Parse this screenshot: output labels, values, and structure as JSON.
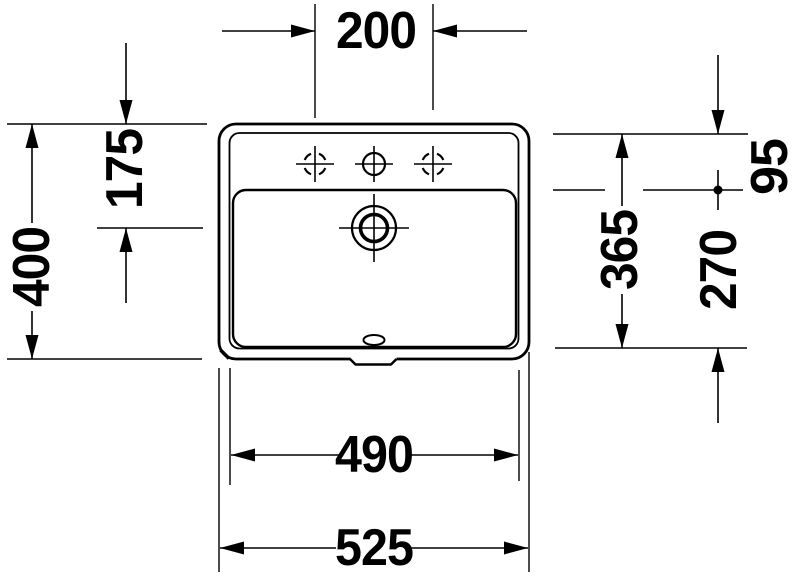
{
  "drawing": {
    "title": "washbasin-technical-drawing-top-view",
    "units": "mm",
    "colors": {
      "line": "#000000",
      "background": "#ffffff"
    },
    "dimensions": {
      "tap_hole_spacing": "200",
      "edge_to_drain": "175",
      "overall_depth": "400",
      "inner_depth": "365",
      "deck_depth": "95",
      "basin_inner_depth": "270",
      "inner_width": "490",
      "overall_width": "525"
    }
  }
}
